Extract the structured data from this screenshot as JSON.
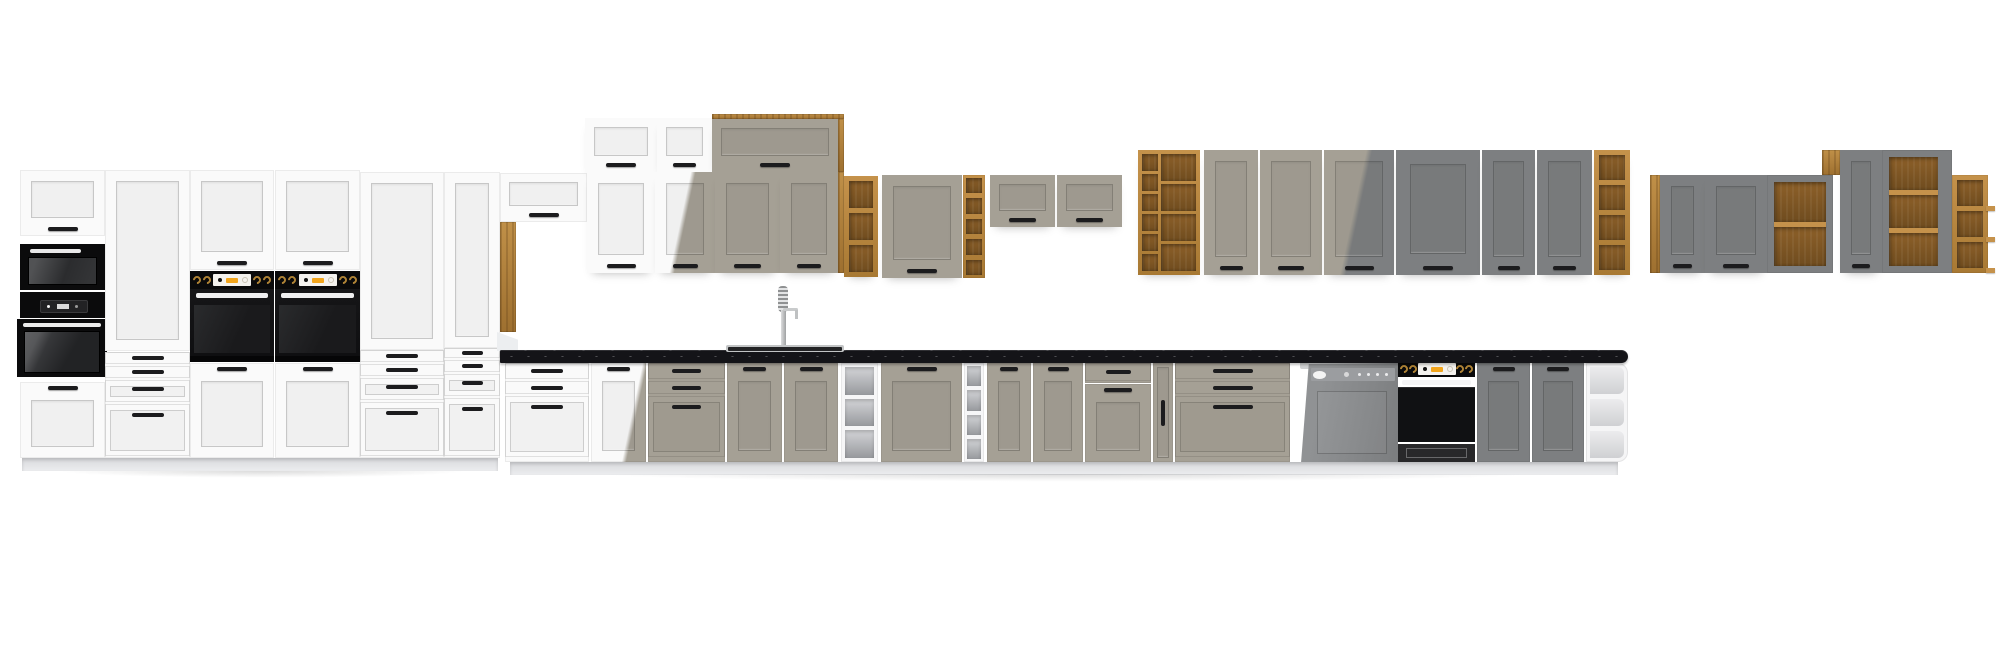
{
  "meta": {
    "description": "3D product render of a modular kitchen furniture programme shown as one long lineup: white, clay-taupe and dark-grey shaker fronts with artisan-oak open shelving, black appliances, black speckled worktop with sink, spring faucet and semi-integrated dishwasher",
    "background": "#ffffff"
  },
  "palette": {
    "white": "#fafafa",
    "taupe": "#a5a095",
    "grey": "#7d7f81",
    "oak_light": "#c5924b",
    "oak_dark": "#8a5f28",
    "counter": "#141418",
    "handle": "#1c1c1e",
    "appliance_black": "#0b0b0c",
    "steel": "#cfd1d2",
    "plinth": "#e9eaec",
    "display_amber": "#f2a51c",
    "knob_gold": "#b08436"
  },
  "scene": {
    "width": 2000,
    "height": 663,
    "modules": [
      {
        "id": "left-wall-door",
        "type": "door",
        "x": 20,
        "y": 170,
        "w": 85,
        "h": 66,
        "color": "white",
        "handle": "bottom"
      },
      {
        "id": "microwave",
        "type": "microwave",
        "x": 20,
        "y": 244,
        "w": 85,
        "h": 46
      },
      {
        "id": "compact-oven",
        "type": "compactOven",
        "x": 20,
        "y": 292,
        "w": 85,
        "h": 26
      },
      {
        "id": "single-oven",
        "type": "ovenSimple",
        "x": 17,
        "y": 319,
        "w": 90,
        "h": 58
      },
      {
        "id": "tall1-front",
        "type": "door",
        "x": 20,
        "y": 382,
        "w": 85,
        "h": 76,
        "color": "white",
        "handle": "top"
      },
      {
        "id": "tall2-door",
        "type": "door",
        "x": 105,
        "y": 170,
        "w": 85,
        "h": 181,
        "color": "white",
        "handle": "none"
      },
      {
        "id": "tall2-drawers",
        "type": "drawers",
        "x": 105,
        "y": 352,
        "w": 85,
        "h": 106,
        "rows": [
          14,
          14,
          24,
          54
        ],
        "color": "white"
      },
      {
        "id": "oven-tower1-door",
        "type": "door",
        "x": 190,
        "y": 170,
        "w": 84,
        "h": 100,
        "color": "white",
        "handle": "bottom"
      },
      {
        "id": "oven-tower1-panel",
        "type": "ovenPanel",
        "x": 190,
        "y": 271,
        "w": 84,
        "h": 18
      },
      {
        "id": "oven-tower1-body",
        "type": "ovenBodyTower",
        "x": 190,
        "y": 289,
        "w": 84,
        "h": 73
      },
      {
        "id": "oven-tower1-front",
        "type": "door",
        "x": 190,
        "y": 363,
        "w": 84,
        "h": 95,
        "color": "white",
        "handle": "top"
      },
      {
        "id": "oven-tower2-door",
        "type": "door",
        "x": 275,
        "y": 170,
        "w": 85,
        "h": 100,
        "color": "white",
        "handle": "bottom"
      },
      {
        "id": "oven-tower2-panel",
        "type": "ovenPanel",
        "x": 275,
        "y": 271,
        "w": 85,
        "h": 18
      },
      {
        "id": "oven-tower2-body",
        "type": "ovenBodyTower",
        "x": 275,
        "y": 289,
        "w": 85,
        "h": 73
      },
      {
        "id": "oven-tower2-front",
        "type": "door",
        "x": 275,
        "y": 363,
        "w": 85,
        "h": 95,
        "color": "white",
        "handle": "top"
      },
      {
        "id": "tall5-door",
        "type": "door",
        "x": 360,
        "y": 172,
        "w": 84,
        "h": 178,
        "color": "white",
        "handle": "none"
      },
      {
        "id": "tall5-drawers",
        "type": "drawers",
        "x": 360,
        "y": 350,
        "w": 84,
        "h": 108,
        "rows": [
          14,
          14,
          24,
          56
        ],
        "color": "white"
      },
      {
        "id": "tall6-door",
        "type": "door",
        "x": 444,
        "y": 172,
        "w": 56,
        "h": 176,
        "color": "white",
        "handle": "none"
      },
      {
        "id": "tall6-drawers",
        "type": "drawers",
        "x": 444,
        "y": 348,
        "w": 56,
        "h": 110,
        "rows": [
          12,
          14,
          24,
          60
        ],
        "color": "white"
      },
      {
        "id": "oak-pillar",
        "type": "oakPanel",
        "x": 500,
        "y": 222,
        "w": 16,
        "h": 110
      },
      {
        "id": "left-plinth",
        "type": "plinth",
        "x": 22,
        "y": 458,
        "w": 476,
        "h": 13
      },
      {
        "id": "left-floor-shadow",
        "type": "shadow",
        "x": 16,
        "y": 471,
        "w": 492,
        "h": 9
      },
      {
        "id": "flip-cab-small",
        "type": "door",
        "flip": true,
        "x": 500,
        "y": 173,
        "w": 87,
        "h": 49,
        "color": "white",
        "handle": "bottom"
      },
      {
        "id": "upper-flip-1",
        "type": "door",
        "flip": true,
        "x": 585,
        "y": 118,
        "w": 72,
        "h": 54,
        "color": "white",
        "handle": "bottom",
        "sh": 1
      },
      {
        "id": "upper-flip-2",
        "type": "door",
        "flip": true,
        "x": 657,
        "y": 118,
        "w": 55,
        "h": 54,
        "color": "white",
        "handle": "bottom",
        "sh": 1
      },
      {
        "id": "upper-oak-top-strip",
        "type": "oakPanel",
        "x": 712,
        "y": 114,
        "w": 132,
        "h": 5
      },
      {
        "id": "upper-flip-3",
        "type": "door",
        "flip": true,
        "x": 712,
        "y": 119,
        "w": 126,
        "h": 53,
        "color": "taupe",
        "handle": "bottom",
        "sh": 1
      },
      {
        "id": "upper-oak-side",
        "type": "oakPanel",
        "x": 838,
        "y": 119,
        "w": 6,
        "h": 53
      },
      {
        "id": "wall-door-1",
        "type": "door",
        "x": 587,
        "y": 172,
        "w": 68,
        "h": 101,
        "color": "white",
        "handle": "bottom",
        "sh": 1
      },
      {
        "id": "wall-door-2",
        "type": "door",
        "x": 655,
        "y": 172,
        "w": 60,
        "h": 101,
        "mix": [
          "white",
          "taupe"
        ],
        "stop": 44,
        "handle": "bottom",
        "sh": 1
      },
      {
        "id": "wall-door-3",
        "type": "door",
        "x": 715,
        "y": 172,
        "w": 65,
        "h": 101,
        "color": "taupe",
        "handle": "bottom",
        "sh": 1
      },
      {
        "id": "wall-door-4",
        "type": "door",
        "x": 780,
        "y": 172,
        "w": 58,
        "h": 101,
        "color": "taupe",
        "handle": "bottom",
        "sh": 1
      },
      {
        "id": "wall-oak-side",
        "type": "oakPanel",
        "x": 838,
        "y": 172,
        "w": 6,
        "h": 101
      },
      {
        "id": "wall-oak-shelf-tower",
        "type": "openOak",
        "x": 844,
        "y": 176,
        "w": 34,
        "h": 101,
        "cells": 3,
        "sh": 1
      },
      {
        "id": "wall-single-door-cab",
        "type": "door",
        "x": 882,
        "y": 175,
        "w": 80,
        "h": 103,
        "color": "taupe",
        "handle": "bottom",
        "sh": 1
      },
      {
        "id": "wall-oak-rack-narrow",
        "type": "openOak",
        "x": 963,
        "y": 175,
        "w": 22,
        "h": 103,
        "cells": 5,
        "f": 3
      },
      {
        "id": "wall-flip-high-1",
        "type": "door",
        "flip": true,
        "x": 990,
        "y": 175,
        "w": 65,
        "h": 52,
        "color": "taupe",
        "handle": "bottom",
        "sh": 1
      },
      {
        "id": "wall-flip-high-2",
        "type": "door",
        "flip": true,
        "x": 1057,
        "y": 175,
        "w": 65,
        "h": 52,
        "color": "taupe",
        "handle": "bottom",
        "sh": 1
      },
      {
        "id": "wall-wine-rack",
        "type": "wineRack",
        "x": 1138,
        "y": 150,
        "w": 62,
        "h": 125,
        "sh": 1
      },
      {
        "id": "wall-tall-door-1",
        "type": "door",
        "x": 1204,
        "y": 150,
        "w": 54,
        "h": 125,
        "color": "taupe",
        "handle": "bottom",
        "sh": 1
      },
      {
        "id": "wall-tall-door-2",
        "type": "door",
        "x": 1260,
        "y": 150,
        "w": 62,
        "h": 125,
        "color": "taupe",
        "handle": "bottom",
        "sh": 1
      },
      {
        "id": "wall-tall-door-3",
        "type": "door",
        "x": 1324,
        "y": 150,
        "w": 70,
        "h": 125,
        "mix": [
          "taupe",
          "grey"
        ],
        "stop": 44,
        "handle": "bottom",
        "sh": 1
      },
      {
        "id": "wall-tall-door-wide",
        "type": "door",
        "x": 1396,
        "y": 150,
        "w": 84,
        "h": 125,
        "color": "grey",
        "handle": "bottom",
        "sh": 1,
        "pad": 14
      },
      {
        "id": "wall-tall-door-4",
        "type": "door",
        "x": 1482,
        "y": 150,
        "w": 53,
        "h": 125,
        "color": "grey",
        "handle": "bottom",
        "sh": 1
      },
      {
        "id": "wall-tall-door-5",
        "type": "door",
        "x": 1537,
        "y": 150,
        "w": 55,
        "h": 125,
        "color": "grey",
        "handle": "bottom",
        "sh": 1
      },
      {
        "id": "wall-oak-end-shelf",
        "type": "openOak",
        "x": 1594,
        "y": 150,
        "w": 36,
        "h": 125,
        "cells": 4,
        "sh": 1
      },
      {
        "id": "faucet",
        "type": "faucet",
        "x": 770,
        "y": 286,
        "w": 30,
        "h": 65
      },
      {
        "id": "base-drawers-1",
        "type": "drawers",
        "x": 505,
        "y": 363,
        "w": 84,
        "h": 99,
        "rows": [
          18,
          15,
          63
        ],
        "color": "white"
      },
      {
        "id": "base-door-1",
        "type": "door",
        "x": 591,
        "y": 363,
        "w": 55,
        "h": 99,
        "mix": [
          "white",
          "taupe"
        ],
        "stop": 68,
        "handle": "top"
      },
      {
        "id": "base-drawers-2",
        "type": "drawers",
        "x": 648,
        "y": 363,
        "w": 77,
        "h": 99,
        "rows": [
          18,
          15,
          63
        ],
        "color": "taupe"
      },
      {
        "id": "base-sink-door",
        "type": "door",
        "x": 727,
        "y": 363,
        "w": 55,
        "h": 99,
        "color": "taupe",
        "handle": "top"
      },
      {
        "id": "base-door-2",
        "type": "door",
        "x": 784,
        "y": 363,
        "w": 54,
        "h": 99,
        "color": "taupe",
        "handle": "top"
      },
      {
        "id": "base-open-shelf",
        "type": "openWhite",
        "x": 841,
        "y": 363,
        "w": 37,
        "h": 99,
        "cells": 3
      },
      {
        "id": "base-door-wide",
        "type": "door",
        "x": 881,
        "y": 363,
        "w": 81,
        "h": 99,
        "color": "taupe",
        "handle": "top"
      },
      {
        "id": "base-rack-white",
        "type": "openWhite",
        "x": 964,
        "y": 363,
        "w": 20,
        "h": 99,
        "cells": 4,
        "f": 3
      },
      {
        "id": "base-door-3",
        "type": "door",
        "x": 987,
        "y": 363,
        "w": 44,
        "h": 99,
        "color": "taupe",
        "handle": "top"
      },
      {
        "id": "base-door-4",
        "type": "door",
        "x": 1033,
        "y": 363,
        "w": 50,
        "h": 99,
        "color": "taupe",
        "handle": "top"
      },
      {
        "id": "base-cab5-drawer",
        "type": "drawers",
        "x": 1085,
        "y": 363,
        "w": 66,
        "h": 20,
        "rows": [
          20
        ],
        "color": "taupe"
      },
      {
        "id": "base-cab5-door",
        "type": "door",
        "x": 1085,
        "y": 384,
        "w": 66,
        "h": 78,
        "color": "taupe",
        "handle": "top"
      },
      {
        "id": "base-filler-door",
        "type": "door",
        "x": 1153,
        "y": 363,
        "w": 20,
        "h": 99,
        "color": "taupe",
        "handle": "vertical",
        "pad": 4
      },
      {
        "id": "base-drawers-3",
        "type": "drawers",
        "x": 1175,
        "y": 363,
        "w": 115,
        "h": 99,
        "rows": [
          18,
          15,
          63
        ],
        "color": "taupe"
      },
      {
        "id": "dishwasher",
        "type": "dishwasher",
        "x": 1298,
        "y": 360,
        "w": 100,
        "h": 103
      },
      {
        "id": "built-in-oven",
        "type": "ovenBase",
        "x": 1398,
        "y": 361,
        "w": 77,
        "h": 101
      },
      {
        "id": "base-door-5",
        "type": "door",
        "x": 1477,
        "y": 363,
        "w": 53,
        "h": 99,
        "color": "grey",
        "handle": "top"
      },
      {
        "id": "base-door-6",
        "type": "door",
        "x": 1532,
        "y": 363,
        "w": 52,
        "h": 99,
        "color": "grey",
        "handle": "top"
      },
      {
        "id": "base-end-shelf",
        "type": "endShelf",
        "x": 1586,
        "y": 363,
        "w": 42,
        "h": 99,
        "cells": 3
      },
      {
        "id": "corner-panel",
        "type": "rect",
        "x": 497,
        "y": 332,
        "w": 21,
        "h": 19,
        "css": "background:#eceef0;clip-path:polygon(0 0,100% 40%,100% 100%,0 100%);"
      },
      {
        "id": "countertop",
        "type": "counter",
        "x": 500,
        "y": 350,
        "w": 1128,
        "h": 13
      },
      {
        "id": "sink-rim",
        "type": "sink",
        "x": 726,
        "y": 345,
        "w": 118,
        "h": 7
      },
      {
        "id": "base-plinth",
        "type": "plinth",
        "x": 510,
        "y": 462,
        "w": 1108,
        "h": 13
      },
      {
        "id": "base-floor-shadow",
        "type": "shadow",
        "x": 500,
        "y": 474,
        "w": 1130,
        "h": 10
      },
      {
        "id": "right-oak-side",
        "type": "oakPanel",
        "x": 1650,
        "y": 175,
        "w": 10,
        "h": 98
      },
      {
        "id": "right-door-1",
        "type": "door",
        "x": 1660,
        "y": 175,
        "w": 45,
        "h": 98,
        "color": "grey",
        "handle": "bottom",
        "sh": 1
      },
      {
        "id": "right-door-2",
        "type": "door",
        "x": 1705,
        "y": 175,
        "w": 62,
        "h": 98,
        "color": "grey",
        "handle": "bottom",
        "sh": 1
      },
      {
        "id": "right-open-cab",
        "type": "openGrey",
        "x": 1767,
        "y": 175,
        "w": 66,
        "h": 98,
        "cells": 2,
        "f": 7
      },
      {
        "id": "right-oak-block",
        "type": "oakPanel",
        "x": 1822,
        "y": 150,
        "w": 18,
        "h": 25
      },
      {
        "id": "right-tall-door",
        "type": "door",
        "x": 1840,
        "y": 150,
        "w": 42,
        "h": 123,
        "color": "grey",
        "handle": "bottom",
        "sh": 1
      },
      {
        "id": "right-tall-open-cab",
        "type": "openGrey",
        "x": 1882,
        "y": 150,
        "w": 70,
        "h": 123,
        "cells": 3,
        "f": 7,
        "fr": 14
      },
      {
        "id": "right-oak-shelves",
        "type": "openOak",
        "x": 1952,
        "y": 175,
        "w": 36,
        "h": 98,
        "cells": 3,
        "lips": true
      }
    ]
  }
}
